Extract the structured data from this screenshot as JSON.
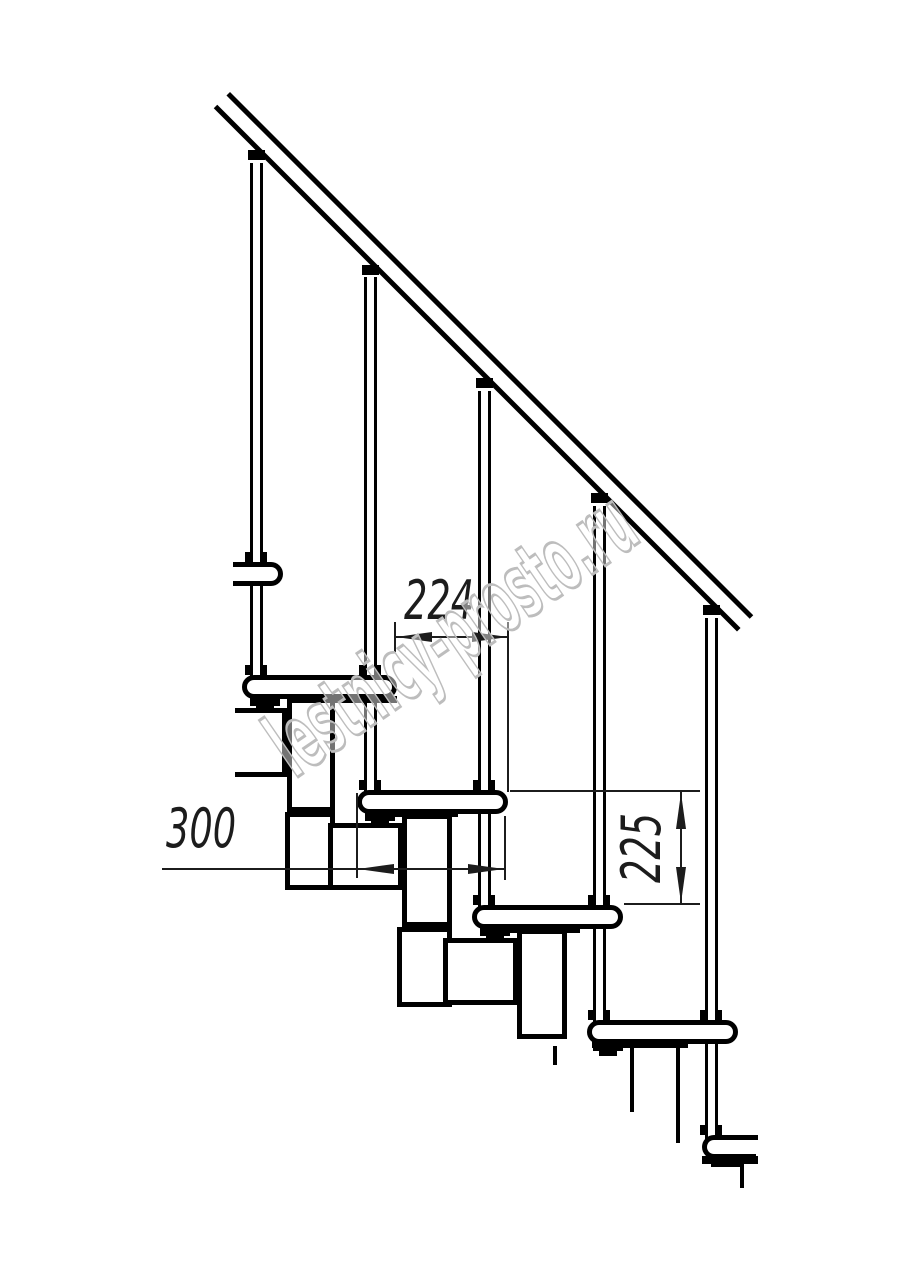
{
  "drawing": {
    "kind": "staircase-side-elevation",
    "colors": {
      "background": "#ffffff",
      "line": "#000000",
      "dimension_line": "#1c1c1c",
      "watermark": "#bdbdbd"
    }
  },
  "dimensions": {
    "run": {
      "label": "224",
      "orientation": "horizontal"
    },
    "depth": {
      "label": "300",
      "orientation": "horizontal"
    },
    "rise": {
      "label": "225",
      "orientation": "vertical"
    }
  },
  "watermark": {
    "text": "lestnicy-prosto.ru"
  }
}
